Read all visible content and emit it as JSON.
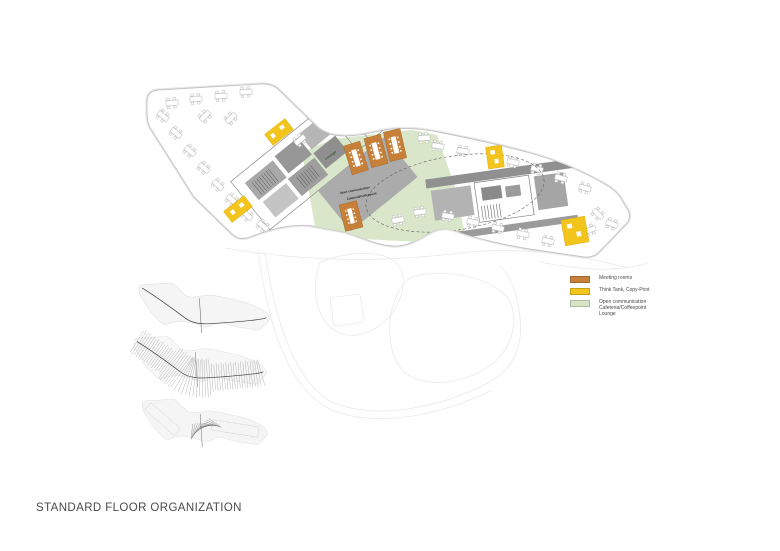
{
  "title": "STANDARD FLOOR ORGANIZATION",
  "colors": {
    "meeting": "#C6803A",
    "think_tank": "#F2C41C",
    "open_comm": "#D7E5C6",
    "title_text": "#4A4A4C"
  },
  "legend": {
    "items": [
      {
        "id": "meeting-rooms",
        "label": "Meeting rooms",
        "color": "#C6803A"
      },
      {
        "id": "think-tank",
        "label": "Think Tank, Copy-Print",
        "color": "#F2C41C"
      },
      {
        "id": "open-communication",
        "label": "Open communication\nCafeteria/Coffeepoint\nLounge",
        "color": "#D7E5C6"
      }
    ]
  },
  "plan": {
    "labels": {
      "lounge": "Lounge",
      "open_comm": "Open communication",
      "cafeteria": "Cafeteria/Coffeepoint"
    }
  }
}
